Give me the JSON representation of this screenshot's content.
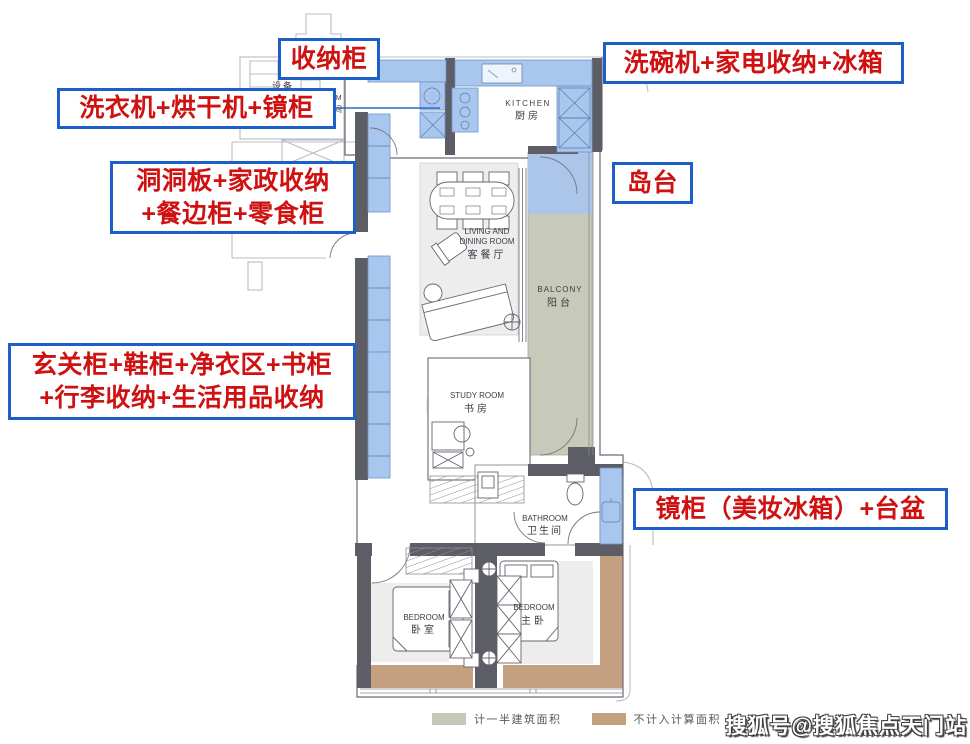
{
  "callouts": {
    "storage": {
      "text": "收纳柜"
    },
    "dishwasher": {
      "text": "洗碗机+家电收纳+冰箱"
    },
    "laundry": {
      "text": "洗衣机+烘干机+镜柜"
    },
    "pegboard": {
      "line1": "洞洞板+家政收纳",
      "line2": "+餐边柜+零食柜"
    },
    "island": {
      "text": "岛台"
    },
    "entry": {
      "line1": "玄关柜+鞋柜+净衣区+书柜",
      "line2": "+行李收纳+生活用品收纳"
    },
    "mirror": {
      "text": "镜柜（美妆冰箱）+台盆"
    }
  },
  "plan": {
    "rooms": {
      "kitchen": {
        "en": "KITCHEN",
        "zh": "厨房"
      },
      "living": {
        "en1": "LIVING AND",
        "en2": "DINING ROOM",
        "zh": "客餐厅"
      },
      "balcony": {
        "en": "BALCONY",
        "zh": "阳台"
      },
      "study": {
        "en": "STUDY ROOM",
        "zh": "书房"
      },
      "bathroom": {
        "en": "BATHROOM",
        "zh": "卫生间"
      },
      "bedroom": {
        "en": "BEDROOM",
        "zh": "卧室"
      },
      "master": {
        "en": "BEDROOM",
        "zh": "主卧"
      },
      "equipment": "设备",
      "laundry_fragment": {
        "en": "OM",
        "zh": "间"
      }
    }
  },
  "legend": {
    "items": [
      {
        "label": "计一半建筑面积",
        "color": "#c3c8b8"
      },
      {
        "label": "不计入计算面积",
        "color": "#c2a080"
      }
    ]
  },
  "watermark": "搜狐号@搜狐焦点天门站",
  "colors": {
    "callout_border": "#1c5fc8",
    "callout_text": "#cf1111",
    "cabinet_fill": "#a9c6ee",
    "balcony_fill": "#c7c9b9",
    "bay_window_fill": "#c2a080",
    "wall_fill": "#5d5d65",
    "leader_line": "#2b6bc4"
  }
}
